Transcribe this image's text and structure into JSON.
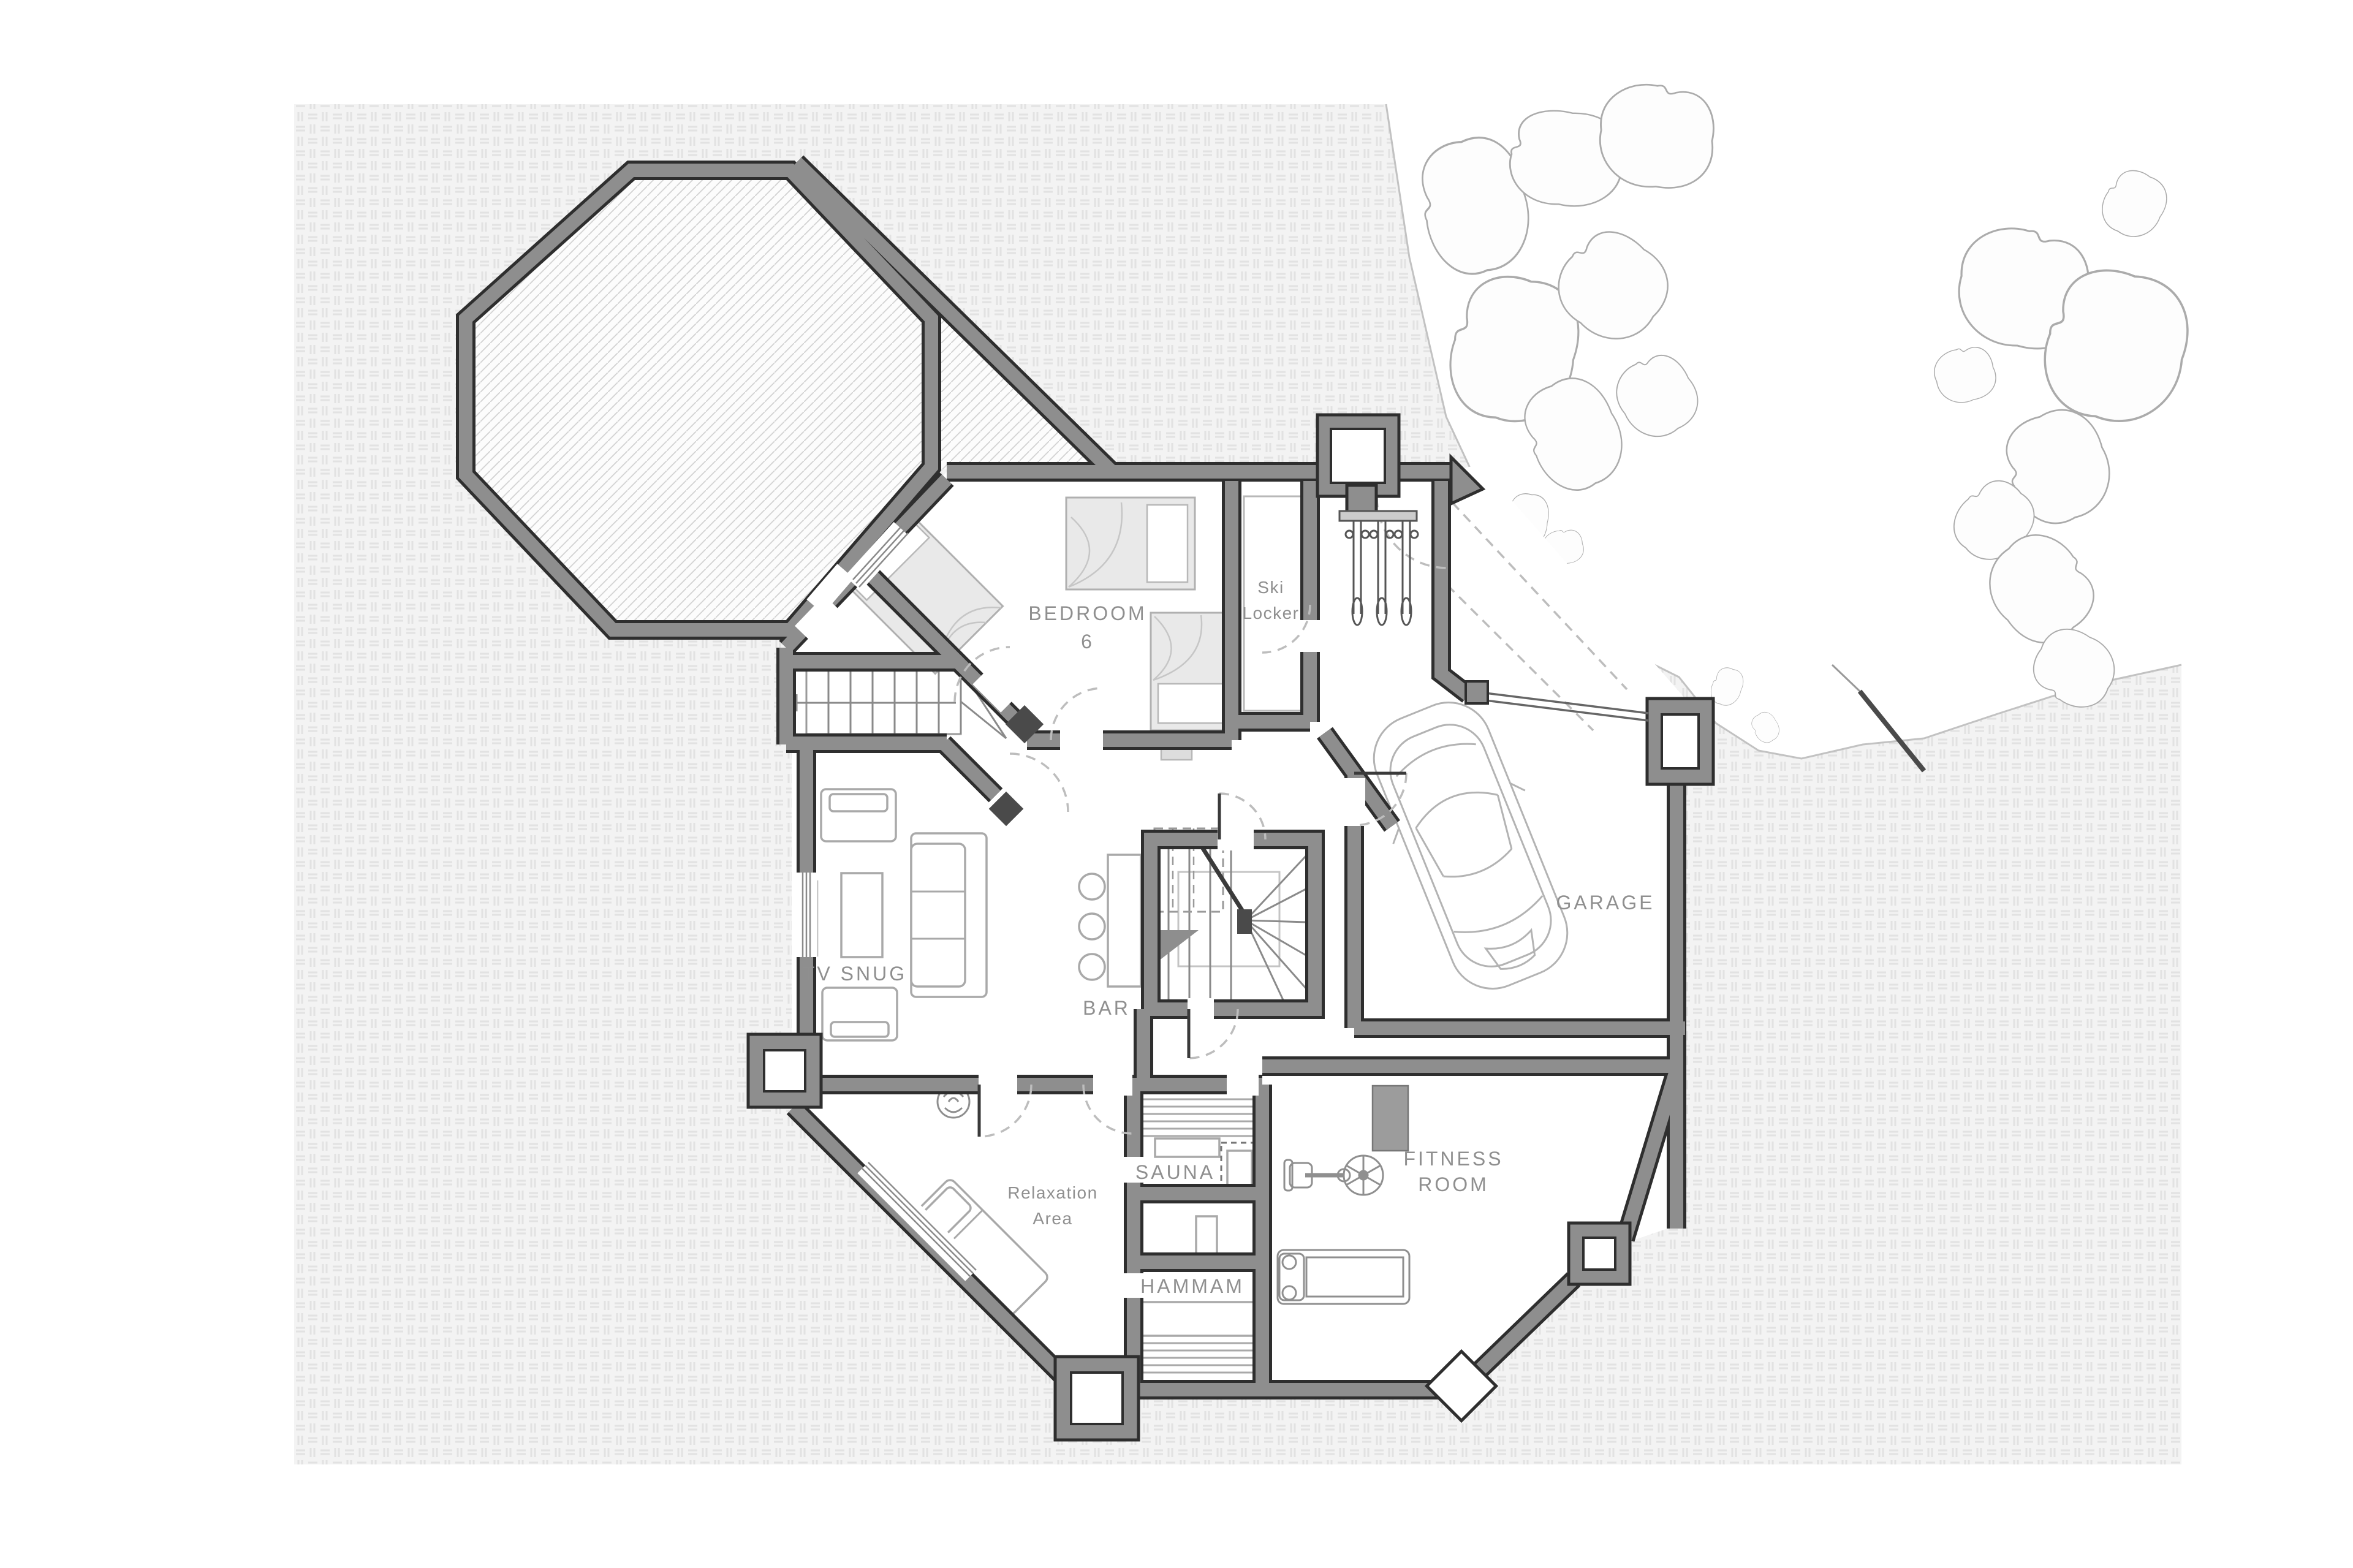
{
  "plan": {
    "title": "Chalet lower floor plan",
    "rooms": {
      "bedroom6": {
        "line1": "BEDROOM",
        "line2": "6"
      },
      "ski_locker": {
        "line1": "Ski",
        "line2": "Locker"
      },
      "garage": {
        "label": "GARAGE"
      },
      "tv_snug": {
        "label": "TV SNUG"
      },
      "bar": {
        "label": "BAR"
      },
      "sauna": {
        "label": "SAUNA"
      },
      "hammam": {
        "label": "HAMMAM"
      },
      "relaxation": {
        "line1": "Relaxation",
        "line2": "Area"
      },
      "fitness": {
        "line1": "FITNESS",
        "line2": "ROOM"
      }
    },
    "colors": {
      "wall_fill": "#8e8e8e",
      "wall_edge": "#2e2e2e",
      "label": "#8f8f8f",
      "floor": "#ffffff",
      "hatch_line": "#d2d2d2",
      "pattern_bg": "#f3f3f3",
      "pattern_mark": "#e2e2e2",
      "furniture_line": "#a9a9a9",
      "bed_fill": "#e9e9e9",
      "dashed": "#bdbdbd",
      "rock_line": "#ababab",
      "dark_detail": "#4a4a4a"
    }
  }
}
